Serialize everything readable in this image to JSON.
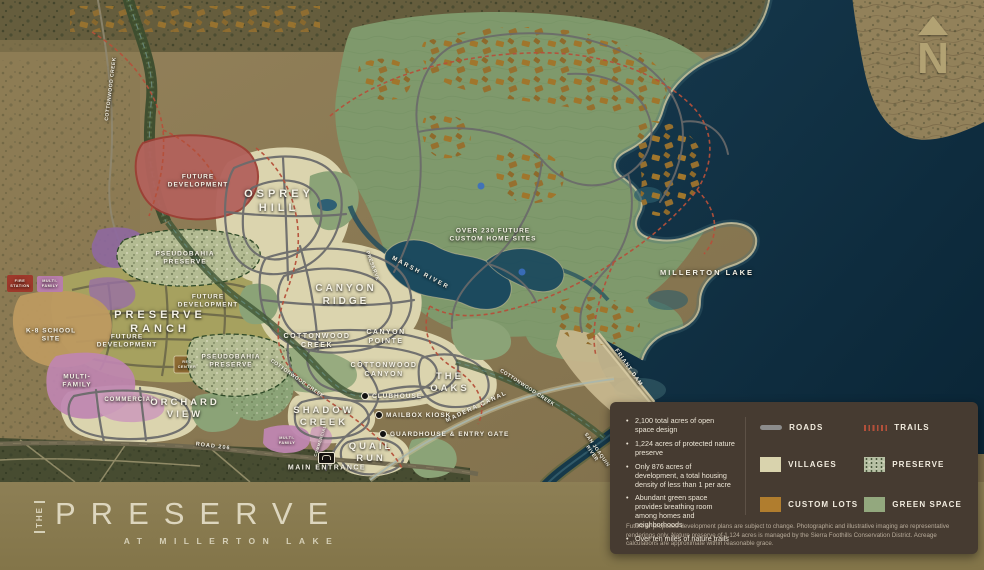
{
  "branding": {
    "the": "THE",
    "name": "PRESERVE",
    "tagline": "AT MILLERTON LAKE"
  },
  "compass_letter": "N",
  "map": {
    "labels": [
      {
        "t": "FUTURE\nDEVELOPMENT",
        "x": 198,
        "y": 182,
        "s": 6.5,
        "ls": 1
      },
      {
        "t": "OSPREY\nHILL",
        "x": 279,
        "y": 201,
        "s": 11,
        "ls": 4
      },
      {
        "t": "PSEUDOBAHIA\nPRESERVE",
        "x": 185,
        "y": 259,
        "s": 6.5,
        "ls": 1
      },
      {
        "t": "FUTURE\nDEVELOPMENT",
        "x": 208,
        "y": 302,
        "s": 6.5,
        "ls": 1
      },
      {
        "t": "PRESERVE\nRANCH",
        "x": 160,
        "y": 322,
        "s": 11,
        "ls": 4
      },
      {
        "t": "FUTURE\nDEVELOPMENT",
        "x": 127,
        "y": 342,
        "s": 6.5,
        "ls": 1
      },
      {
        "t": "PSEUDOBAHIA\nPRESERVE",
        "x": 231,
        "y": 362,
        "s": 6.5,
        "ls": 1
      },
      {
        "t": "K-8 SCHOOL\nSITE",
        "x": 51,
        "y": 336,
        "s": 6.5,
        "ls": 1
      },
      {
        "t": "MULTI-\nFAMILY",
        "x": 77,
        "y": 382,
        "s": 6.5,
        "ls": 1
      },
      {
        "t": "COMMERCIAL",
        "x": 130,
        "y": 401,
        "s": 6,
        "ls": 1
      },
      {
        "t": "FIRE\nSTATION",
        "x": 20,
        "y": 284,
        "s": 3.8
      },
      {
        "t": "MULTI-\nFAMILY",
        "x": 50,
        "y": 284,
        "s": 3.8
      },
      {
        "t": "ORCHARD\nVIEW",
        "x": 185,
        "y": 409,
        "s": 9.5,
        "ls": 3
      },
      {
        "t": "SHADOW\nCREEK",
        "x": 324,
        "y": 417,
        "s": 9.5,
        "ls": 3
      },
      {
        "t": "QUAIL\nRUN",
        "x": 371,
        "y": 453,
        "s": 9.5,
        "ls": 3
      },
      {
        "t": "CANYON\nRIDGE",
        "x": 346,
        "y": 296,
        "s": 10,
        "ls": 3
      },
      {
        "t": "COTTONWOOD\nCREEK",
        "x": 317,
        "y": 342,
        "s": 7,
        "ls": 1.5
      },
      {
        "t": "CANYON\nPOINTE",
        "x": 386,
        "y": 338,
        "s": 7,
        "ls": 1.5
      },
      {
        "t": "COTTONWOOD\nCANYON",
        "x": 384,
        "y": 371,
        "s": 7,
        "ls": 1.5
      },
      {
        "t": "THE\nOAKS",
        "x": 450,
        "y": 383,
        "s": 9.5,
        "ls": 3
      },
      {
        "t": "OVER 230 FUTURE\nCUSTOM HOME SITES",
        "x": 493,
        "y": 236,
        "s": 6.5,
        "ls": 1
      },
      {
        "t": "MILLERTON LAKE",
        "x": 707,
        "y": 273,
        "s": 7.5,
        "ls": 2
      },
      {
        "t": "MARSH RIVER",
        "x": 420,
        "y": 274,
        "s": 6,
        "ls": 2,
        "r": 28
      },
      {
        "t": "COTTONWOOD CREEK",
        "x": 297,
        "y": 379,
        "s": 5,
        "r": 35
      },
      {
        "t": "COTTONWOOD CREEK",
        "x": 527,
        "y": 388,
        "s": 5,
        "r": 33
      },
      {
        "t": "COTTONWOOD CREEK",
        "x": 111,
        "y": 89,
        "s": 5,
        "r": -83
      },
      {
        "t": "MADERA CANAL",
        "x": 477,
        "y": 408,
        "s": 6,
        "ls": 1.5,
        "r": -25
      },
      {
        "t": "FRIANT DAM",
        "x": 628,
        "y": 368,
        "s": 5.5,
        "ls": 1,
        "r": 55
      },
      {
        "t": "SAN JOAQUIN\nRIVER",
        "x": 594,
        "y": 452,
        "s": 5,
        "r": 55
      },
      {
        "t": "ROAD 206",
        "x": 213,
        "y": 447,
        "s": 5.5,
        "ls": 1,
        "r": 7
      },
      {
        "t": "MAIN ENTRANCE",
        "x": 327,
        "y": 469,
        "s": 7,
        "ls": 1.5
      },
      {
        "t": "PRESERVE",
        "x": 372,
        "y": 266,
        "s": 5,
        "r": 70
      },
      {
        "t": "REC\nCENTER",
        "x": 187,
        "y": 365,
        "s": 3.8
      },
      {
        "t": "MULTI-\nFAMILY",
        "x": 287,
        "y": 441,
        "s": 3.8
      },
      {
        "t": "COMMERCIAL",
        "x": 320,
        "y": 441,
        "s": 4,
        "r": -72
      }
    ],
    "pois": [
      {
        "t": "CLUBHOUSE",
        "x": 365,
        "y": 396
      },
      {
        "t": "MAILBOX KIOSK",
        "x": 379,
        "y": 415
      },
      {
        "t": "GUARDHOUSE & ENTRY GATE",
        "x": 383,
        "y": 434
      }
    ]
  },
  "info_panel": {
    "bullets": [
      "2,100 total acres of open space design",
      "1,224 acres of protected nature preserve",
      "Only 876 acres of development, a total housing density of less than 1 per acre",
      "Abundant green space provides breathing room among homes and neighborhoods",
      "Over ten miles of nature trails"
    ],
    "legend": [
      {
        "label": "ROADS",
        "type": "roads"
      },
      {
        "label": "TRAILS",
        "type": "trails"
      },
      {
        "label": "VILLAGES",
        "type": "villages"
      },
      {
        "label": "PRESERVE",
        "type": "preserve"
      },
      {
        "label": "CUSTOM LOTS",
        "type": "custom-lots"
      },
      {
        "label": "GREEN SPACE",
        "type": "green-space"
      }
    ],
    "disclaimer": "Future or proposed development plans are subject to change. Photographic and illustrative imaging are representative renderings only. Nature preserve of 1,124 acres is managed by the Sierra Foothills Conservation District. Acreage calculations are approximate within reasonable grace."
  },
  "colors": {
    "panel_bg": "#463b31",
    "band_bg": "#867851",
    "lake": "#0e2f41",
    "trail": "#b5503a",
    "road": "#6c6c6c",
    "village": "#d9d3ad",
    "preserve": "#b7c0a4",
    "custom_lots": "#b07d2e",
    "green_space": "#93a87e"
  }
}
